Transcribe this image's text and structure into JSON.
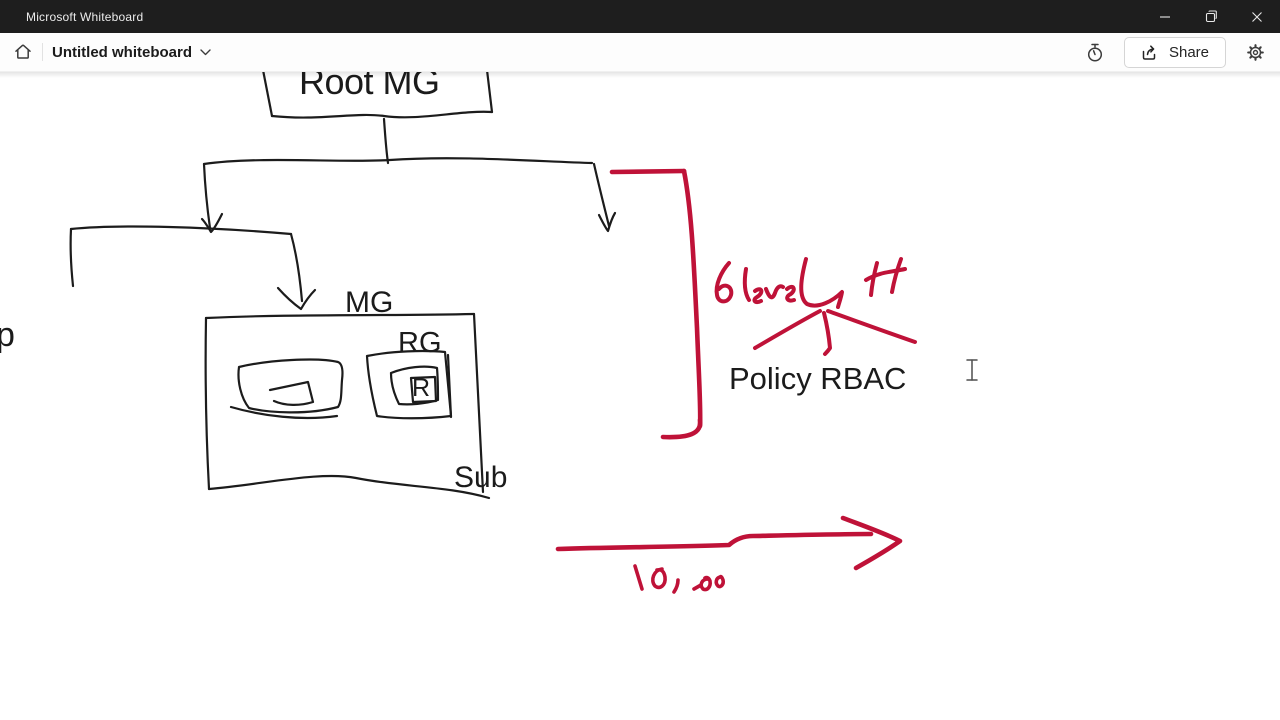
{
  "window": {
    "title": "Microsoft Whiteboard"
  },
  "toolbar": {
    "board_title": "Untitled whiteboard",
    "share_label": "Share"
  },
  "canvas": {
    "typed_labels": {
      "root_mg": "Root MG",
      "mg": "MG",
      "rg": "RG",
      "r": "R",
      "sub": "Sub",
      "policy_rbac": "Policy RBAC",
      "clipped_left_text": "p"
    },
    "handwritten_notes": {
      "red_note": "6 level H",
      "red_numbers": "10, 200"
    },
    "ink_colors": {
      "black": "#1c1c1c",
      "red": "#bf1238"
    }
  }
}
